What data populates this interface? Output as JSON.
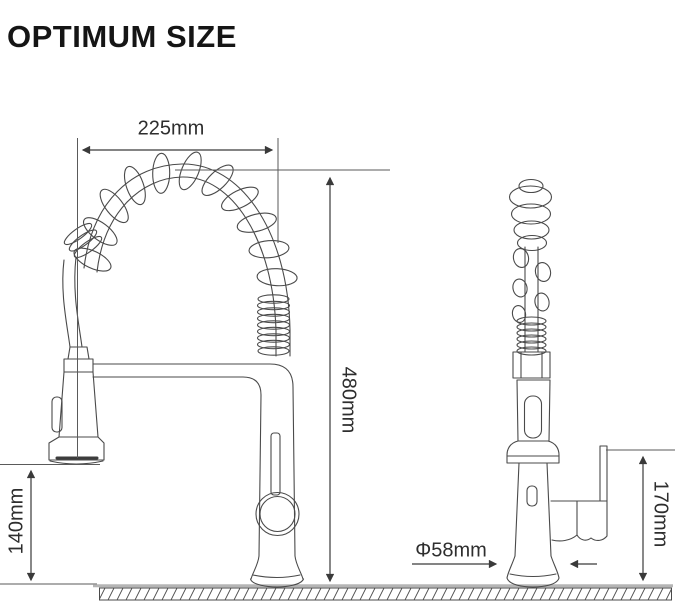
{
  "title": "OPTIMUM SIZE",
  "dims": {
    "spout_width": "225mm",
    "overall_height": "480mm",
    "head_to_counter": "140mm",
    "handle_height": "170mm",
    "base_diameter": "Φ58mm"
  }
}
